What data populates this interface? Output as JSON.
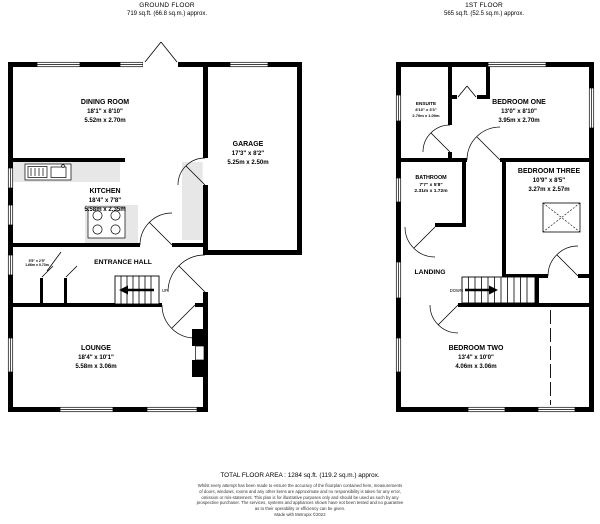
{
  "ground_floor": {
    "title": "GROUND FLOOR",
    "area": "719 sq.ft. (66.8 sq.m.) approx.",
    "stairs_label": "UP",
    "rooms": {
      "dining_room": {
        "name": "DINING ROOM",
        "imperial": "18'1\" x 8'10\"",
        "metric": "5.52m x 2.70m"
      },
      "garage": {
        "name": "GARAGE",
        "imperial": "17'3\" x 8'2\"",
        "metric": "5.25m x 2.50m"
      },
      "kitchen": {
        "name": "KITCHEN",
        "imperial": "18'4\" x 7'8\"",
        "metric": "5.58m x 2.35m"
      },
      "entrance_hall": {
        "name": "ENTRANCE HALL"
      },
      "lounge": {
        "name": "LOUNGE",
        "imperial": "18'4\" x 10'1\"",
        "metric": "5.58m x 3.06m"
      },
      "cupboard": {
        "imperial": "5'5\" x 2'5\"",
        "metric": "1.66m x 0.73m"
      }
    }
  },
  "first_floor": {
    "title": "1ST FLOOR",
    "area": "565 sq.ft. (52.5 sq.m.) approx.",
    "stairs_label": "DOWN",
    "rooms": {
      "ensuite": {
        "name": "ENSUITE",
        "imperial": "8'10\" x 3'3\"",
        "metric": "2.70m x 1.00m"
      },
      "bedroom_one": {
        "name": "BEDROOM ONE",
        "imperial": "13'0\" x 8'10\"",
        "metric": "3.95m x 2.70m"
      },
      "bathroom": {
        "name": "BATHROOM",
        "imperial": "7'7\" x 5'8\"",
        "metric": "2.31m x 1.72m"
      },
      "bedroom_three": {
        "name": "BEDROOM THREE",
        "imperial": "10'9\" x 8'5\"",
        "metric": "3.27m x 2.57m"
      },
      "landing": {
        "name": "LANDING"
      },
      "bedroom_two": {
        "name": "BEDROOM TWO",
        "imperial": "13'4\" x 10'0\"",
        "metric": "4.06m x 3.06m"
      }
    }
  },
  "footer": {
    "total_area": "TOTAL FLOOR AREA : 1284 sq.ft. (119.2 sq.m.) approx.",
    "disclaimer_lines": [
      "Whilst every attempt has been made to ensure the accuracy of the floorplan contained here, measurements",
      "of doors, windows, rooms and any other items are approximate and no responsibility is taken for any error,",
      "omission or mis-statement. This plan is for illustrative purposes only and should be used as such by any",
      "prospective purchaser. The services, systems and appliances shown have not been tested and no guarantee",
      "as to their operability or efficiency can be given."
    ],
    "credit": "Made with Metropix ©2022"
  },
  "colors": {
    "wall": "#000000",
    "fixture": "#e7e7e7",
    "background": "#ffffff"
  }
}
